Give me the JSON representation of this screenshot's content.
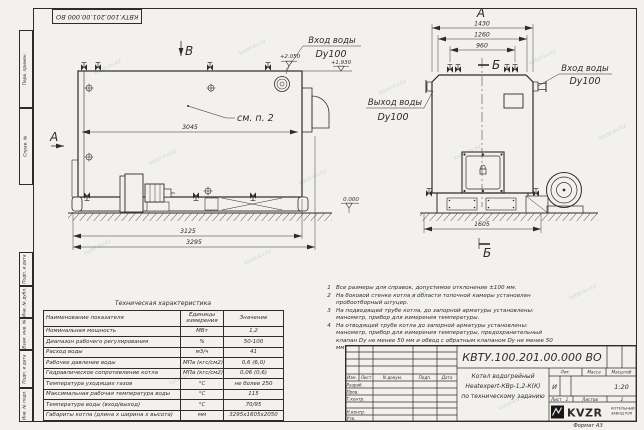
{
  "sheet": {
    "stamp_top": "КВТУ.100.201.00.000 ВО",
    "format": "Формат А3",
    "watermark": "kotel-kv.kz",
    "side_labels_top": [
      "Перв. примен.",
      "Справ. №"
    ],
    "side_labels_bottom": [
      "Подп. и дата",
      "Инв. № дубл.",
      "Взам. инв. №",
      "Подп. и дата",
      "Инв. № подл."
    ]
  },
  "drawing": {
    "view_a": "А",
    "view_b": "В",
    "section_b": "Б",
    "see_note": "см. п. 2",
    "elev_2050": "+2.050",
    "elev_1930": "+1.930",
    "elev_0": "0.000",
    "dim_3045": "3045",
    "dim_3125": "3125",
    "dim_3295": "3295",
    "dim_1430": "1430",
    "dim_1260": "1260",
    "dim_960": "960",
    "dim_1605": "1605",
    "inlet_label": "Вход воды",
    "inlet_dn": "Dy100",
    "outlet_label": "Выход воды",
    "outlet_dn": "Dy100"
  },
  "tech": {
    "title": "Техническая характеристика",
    "col_name": "Наименование показателя",
    "col_unit": "Единицы измерения",
    "col_value": "Значение",
    "rows": [
      {
        "name": "Номинальная мощность",
        "unit": "МВт",
        "value": "1,2"
      },
      {
        "name": "Диапазон рабочего регулирования",
        "unit": "%",
        "value": "50-100"
      },
      {
        "name": "Расход воды",
        "unit": "м3/ч",
        "value": "41"
      },
      {
        "name": "Рабочее давление воды",
        "unit": "МПа (кгс/см2)",
        "value": "0,6 (6,0)"
      },
      {
        "name": "Гидравлическое сопротивление котла",
        "unit": "МПа (кгс/см2)",
        "value": "0,06 (0,6)"
      },
      {
        "name": "Температура уходящих газов",
        "unit": "°С",
        "value": "не более 250"
      },
      {
        "name": "Максимальная рабочая температура воды",
        "unit": "°С",
        "value": "115"
      },
      {
        "name": "Температура воды (вход/выход)",
        "unit": "°С",
        "value": "70/95"
      },
      {
        "name": "Габариты котла (длина х ширина х высота)",
        "unit": "мм",
        "value": "3295х1605х2050"
      }
    ]
  },
  "notes": {
    "items": [
      {
        "n": "1",
        "text": "Все размеры для справок, допустимое отклонение ±100 мм."
      },
      {
        "n": "2",
        "text": "На боковой стенке котла в области топочной камеры установлен пробоотборный штуцер."
      },
      {
        "n": "3",
        "text": "На подводящей трубе котла, до запорной арматуры установлены: манометр, прибор для измерения температуры."
      },
      {
        "n": "4",
        "text": "На отводящей трубе котла до запорной арматуры установлены: манометр, прибор для измерения температуры, предохранительный клапан Dу не менее 50 мм и обвод с обратным клапаном Dу не менее 50 мм."
      }
    ]
  },
  "tb": {
    "doc_number": "КВТУ.100.201.00.000 ВО",
    "product_line1": "Котел водогрейный",
    "product_line2": "Heatexpert-КВр-1,2-К(К)",
    "product_line3": "по техническому заданию",
    "h_izm": "Изм.",
    "h_list": "Лист",
    "h_ndoc": "N докум.",
    "h_podp": "Подп.",
    "h_data": "Дата",
    "r1": "Разраб.",
    "r2": "Пров.",
    "r3": "Т.контр.",
    "r4": "Н.контр.",
    "r5": "Утв.",
    "lit": "Лит.",
    "lit_val": "И",
    "mass": "Масса",
    "scale": "Масштаб",
    "scale_val": "1:20",
    "sheet_label": "Лист",
    "sheet_val": "1",
    "sheets_label": "Листов",
    "sheets_val": "2",
    "logo": "KVZR",
    "logo_cap1": "КОТЕЛЬНЫЙ",
    "logo_cap2": "ЗАВОД РЭП"
  }
}
